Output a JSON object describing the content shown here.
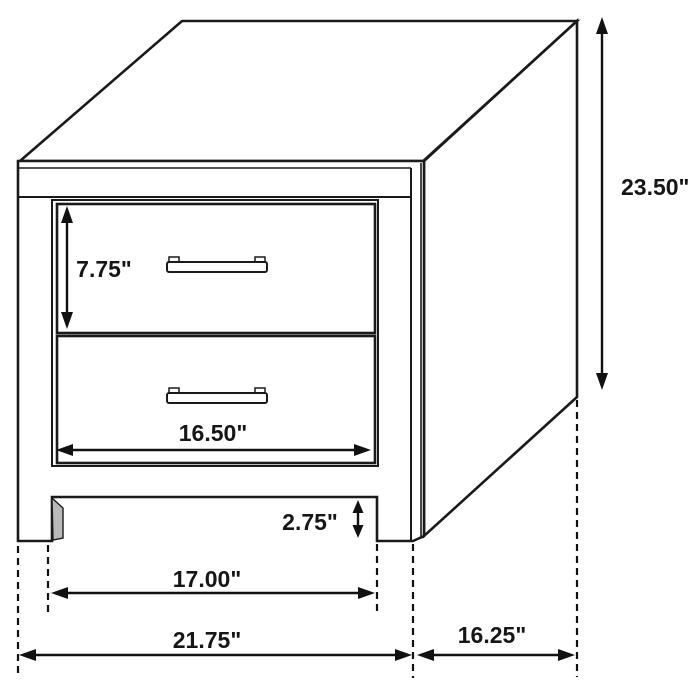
{
  "diagram": {
    "type": "furniture-dimension-drawing",
    "subject": "two-drawer nightstand in perspective with dimension callouts",
    "colors": {
      "background": "#ffffff",
      "line": "#1a1a1a",
      "dimension": "#111111"
    },
    "icons": {
      "drawer_handle": "bar-pull-handle"
    },
    "labels": {
      "height": "23.50\"",
      "drawer_height": "7.75\"",
      "drawer_width": "16.50\"",
      "clearance": "2.75\"",
      "inner_leg_span": "17.00\"",
      "overall_width": "21.75\"",
      "depth": "16.25\""
    }
  }
}
